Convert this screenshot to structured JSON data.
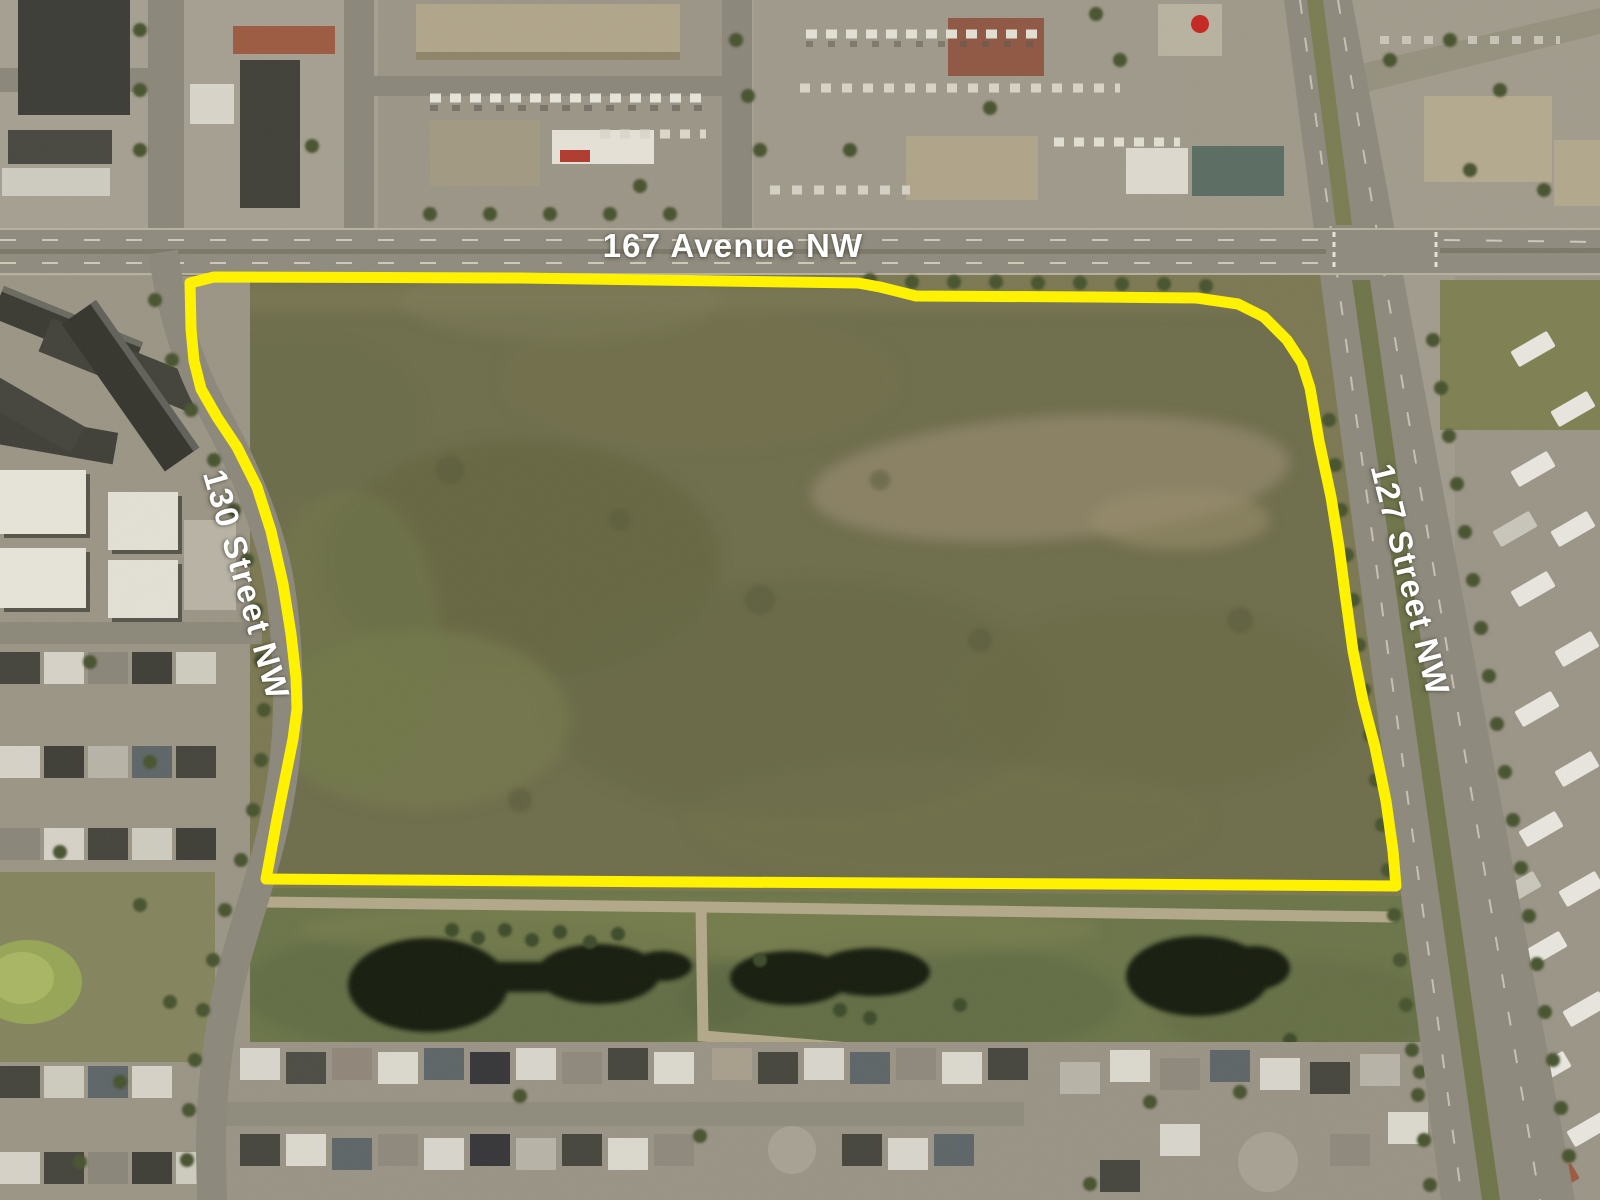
{
  "map": {
    "type": "aerial-imagery-with-parcel-outline",
    "labels": {
      "avenue_167": "167 Avenue NW",
      "street_130": "130 Street NW",
      "street_127": "127 Street NW"
    },
    "label_color": "#ffffff",
    "parcel": {
      "boundary_color": "#fff200",
      "boundary_points": "190,283 214,277 520,278 858,283 880,287 916,296 1095,297 1197,298 1238,304 1264,317 1287,340 1302,363 1310,388 1319,441 1331,497 1339,547 1345,593 1353,651 1363,701 1375,747 1386,801 1393,851 1396,886 1100,884 700,882 400,880 266,879 271,852 277,819 286,774 293,739 297,709 296,678 291,634 283,584 271,531 257,487 237,447 217,417 201,389 194,361 191,329"
    }
  }
}
